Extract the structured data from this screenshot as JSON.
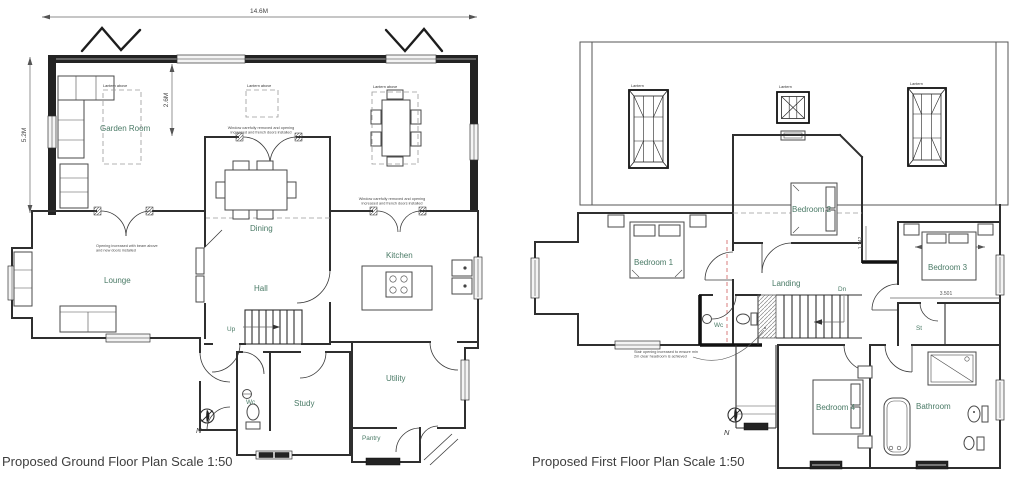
{
  "colors": {
    "background": "#ffffff",
    "wall": "#2f2f2f",
    "room_label": "#4a7a66",
    "title": "#3e3e3e",
    "red_dashed_line": "#d46f6f"
  },
  "ground_floor": {
    "title": "Proposed Ground Floor Plan Scale 1:50",
    "north_label": "N",
    "dimensions": {
      "overall_width": "14.6M",
      "overall_depth": "5.2M",
      "garden_room_depth": "2.6M"
    },
    "rooms": {
      "garden_room": "Garden Room",
      "dining": "Dining",
      "kitchen": "Kitchen",
      "lounge": "Lounge",
      "hall": "Hall",
      "study": "Study",
      "utility": "Utility",
      "pantry": "Pantry",
      "wc": "Wc",
      "up": "Up"
    },
    "annotations": {
      "lantern_above_garden": "Lantern above",
      "lantern_above_dining": "Lantern above",
      "lantern_above_breakfast": "Lantern above",
      "dining_doors": "Window carefully removed and opening\nincreased and french doors installed",
      "kitchen_doors": "Window carefully removed and opening\nincreased and french doors installed",
      "lounge_opening": "Opening increased with beam above\nand new doors installed"
    }
  },
  "first_floor": {
    "title": "Proposed First Floor Plan Scale 1:50",
    "north_label": "N",
    "dimensions": {
      "bedroom3_width": "4.630",
      "bedroom3_depth": "3.501",
      "landing_width": "1.342"
    },
    "rooms": {
      "bedroom1": "Bedroom 1",
      "bedroom2": "Bedroom 2",
      "bedroom3": "Bedroom 3",
      "bedroom4": "Bedroom 4",
      "landing": "Landing",
      "bathroom": "Bathroom",
      "wc": "Wc",
      "store": "St",
      "down": "Dn"
    },
    "annotations": {
      "lantern_left": "Lantern",
      "lantern_middle": "Lantern",
      "lantern_right": "Lantern",
      "stair_opening": "Stair opening increased to ensure min\n2m clear headroom is achieved"
    }
  }
}
